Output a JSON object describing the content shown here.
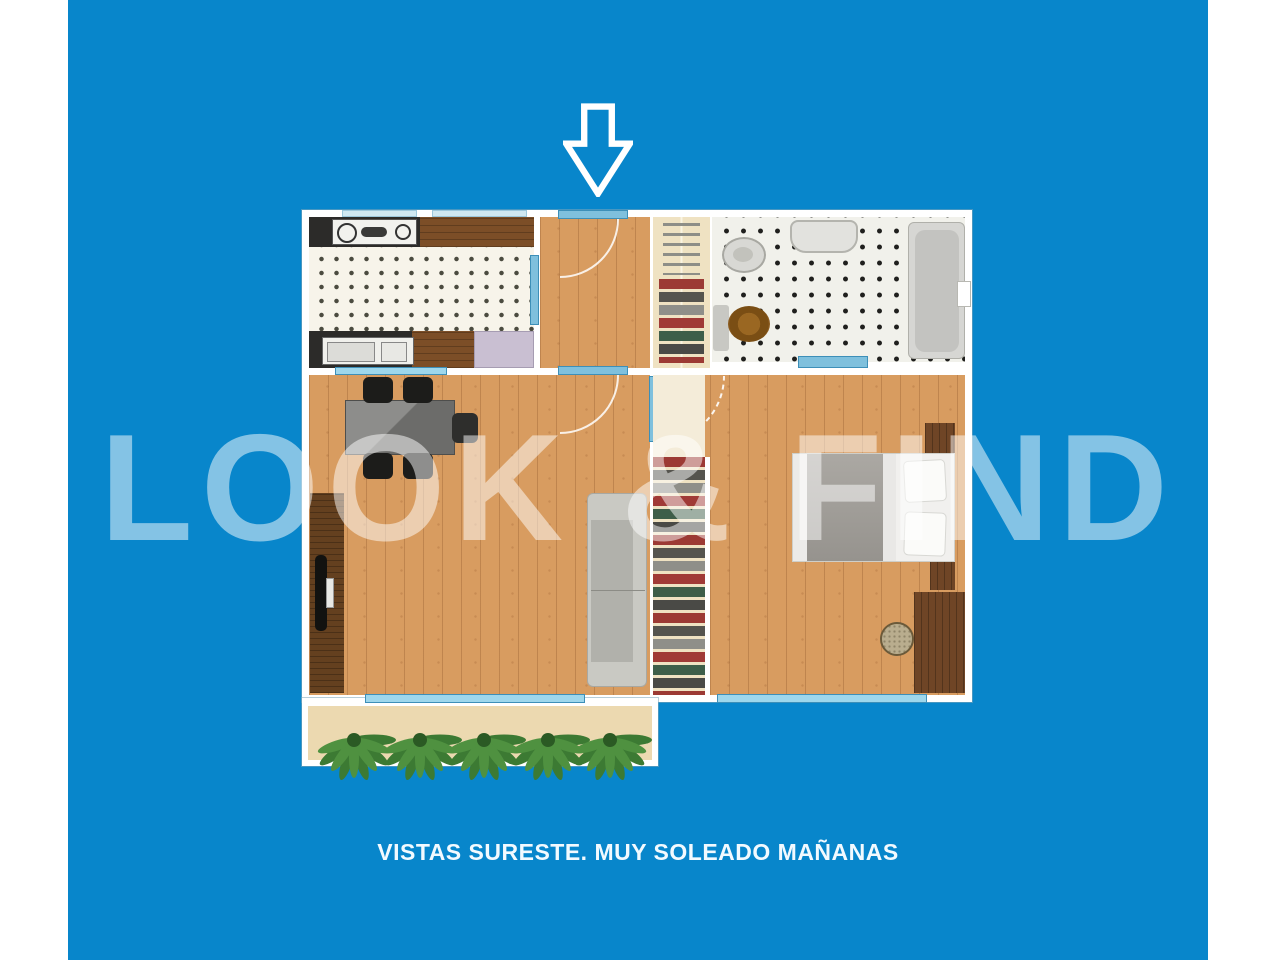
{
  "page": {
    "background_color": "#ffffff",
    "canvas_color": "#0886cb"
  },
  "watermark": {
    "text": "LOOK & FIND",
    "color": "#ffffff",
    "opacity": 0.5
  },
  "caption": {
    "text": "VISTAS SURESTE. MUY SOLEADO MAÑANAS",
    "color": "#f2faff"
  },
  "entrance_arrow": {
    "icon": "down-arrow-icon",
    "color": "#ffffff"
  },
  "floorplan": {
    "wall_color": "#ffffff",
    "wood_floor_color": "#d89c60",
    "window_color": "#9ed7ec",
    "kitchen_tile_color": "#f7f4ea",
    "bath_tile_color": "#f1f1eb",
    "terrace_floor_color": "#ecd9b0",
    "rooms": [
      {
        "name": "kitchen"
      },
      {
        "name": "entrance-hall"
      },
      {
        "name": "hall-closet"
      },
      {
        "name": "bathroom"
      },
      {
        "name": "living-dining-room"
      },
      {
        "name": "bedroom"
      },
      {
        "name": "bedroom-closet"
      },
      {
        "name": "terrace"
      }
    ],
    "furniture": [
      "stove",
      "kitchen-sink",
      "refrigerator",
      "toilet",
      "washbasin",
      "bathtub",
      "bath-rug",
      "bath-mat",
      "dining-table",
      "dining-chairs",
      "sideboard",
      "tv",
      "sofa",
      "double-bed",
      "pillows",
      "nightstands",
      "wardrobe",
      "round-rug",
      "terrace-plants"
    ]
  }
}
